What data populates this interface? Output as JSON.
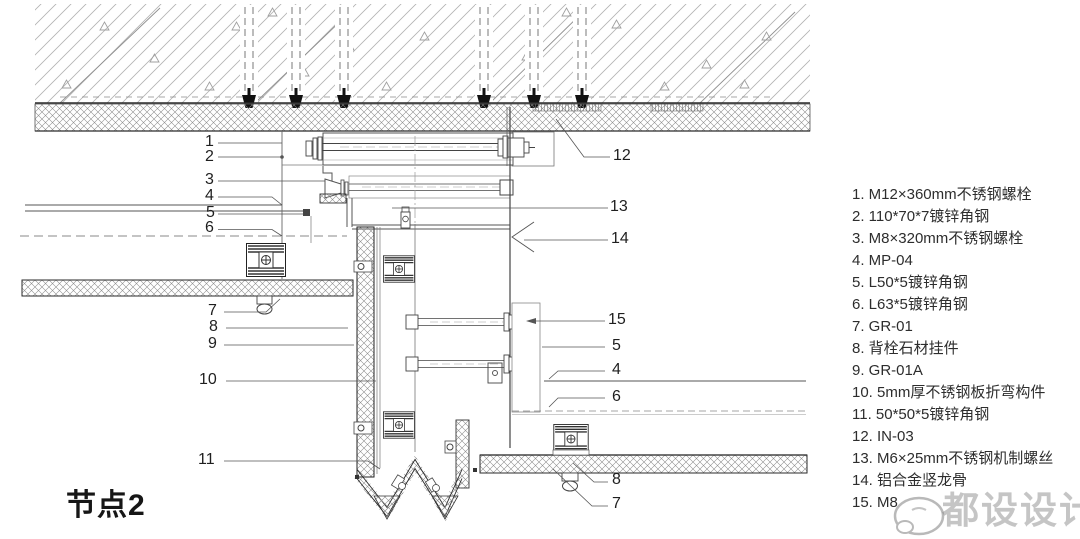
{
  "title": "节点2",
  "legend": {
    "items": [
      "1. M12×360mm不锈钢螺栓",
      "2. 110*70*7镀锌角钢",
      "3. M8×320mm不锈钢螺栓",
      "4. MP-04",
      "5. L50*5镀锌角钢",
      "6. L63*5镀锌角钢",
      "7. GR-01",
      "8. 背栓石材挂件",
      "9. GR-01A",
      "10. 5mm厚不锈钢板折弯构件",
      "11. 50*50*5镀锌角钢",
      "12. IN-03",
      "13. M6×25mm不锈钢机制螺丝",
      "14. 铝合金竖龙骨",
      "15. M8"
    ]
  },
  "callouts": [
    {
      "label": "1"
    },
    {
      "label": "2"
    },
    {
      "label": "3"
    },
    {
      "label": "4"
    },
    {
      "label": "5"
    },
    {
      "label": "6"
    },
    {
      "label": "7"
    },
    {
      "label": "8"
    },
    {
      "label": "9"
    },
    {
      "label": "10"
    },
    {
      "label": "11"
    },
    {
      "label": "12"
    },
    {
      "label": "13"
    },
    {
      "label": "14"
    },
    {
      "label": "15"
    },
    {
      "label": "5"
    },
    {
      "label": "4"
    },
    {
      "label": "6"
    },
    {
      "label": "8"
    },
    {
      "label": "7"
    }
  ],
  "watermark": {
    "text": "都设设计",
    "logo": "speech-bubble-logo"
  },
  "colors": {
    "background": "#ffffff",
    "line": "#555555",
    "dark_line": "#222222",
    "crosshatch": "#8c8c8c",
    "concrete_hatch": "#b3b3b3",
    "legend_text": "#2d2d2d",
    "callout_text": "#1f1f1f",
    "watermark": "#8c8c8c"
  }
}
